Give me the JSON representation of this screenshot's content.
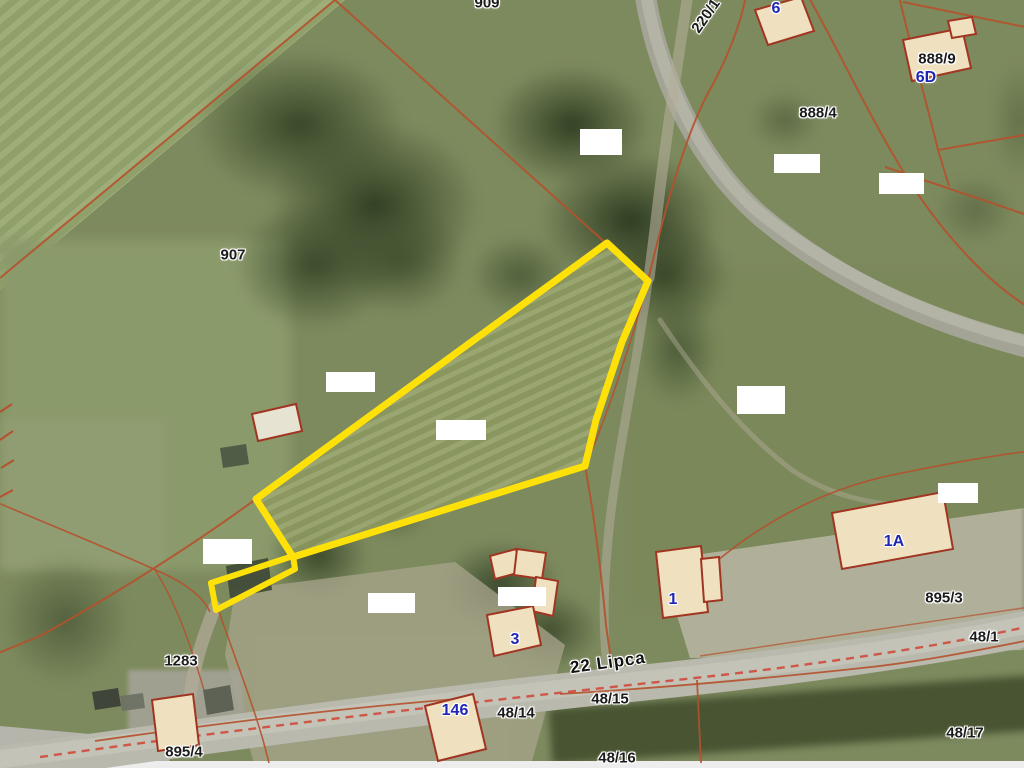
{
  "map": {
    "type": "cadastral-aerial-map",
    "street_label": {
      "text": "22 Lipca",
      "x": 608,
      "y": 663,
      "rotate": -8
    },
    "parcel_labels": [
      {
        "text": "909",
        "x": 487,
        "y": 3
      },
      {
        "text": "220/1",
        "x": 706,
        "y": 16,
        "rotate": -55
      },
      {
        "text": "907",
        "x": 233,
        "y": 255
      },
      {
        "text": "888/4",
        "x": 818,
        "y": 113
      },
      {
        "text": "888/9",
        "x": 937,
        "y": 59
      },
      {
        "text": "895/3",
        "x": 944,
        "y": 598
      },
      {
        "text": "48/1",
        "x": 984,
        "y": 637
      },
      {
        "text": "48/15",
        "x": 610,
        "y": 699
      },
      {
        "text": "48/14",
        "x": 516,
        "y": 713
      },
      {
        "text": "48/16",
        "x": 617,
        "y": 758
      },
      {
        "text": "48/17",
        "x": 965,
        "y": 733
      },
      {
        "text": "895/4",
        "x": 184,
        "y": 752
      },
      {
        "text": "1283",
        "x": 181,
        "y": 661
      }
    ],
    "address_labels": [
      {
        "text": "6",
        "x": 776,
        "y": 9
      },
      {
        "text": "6D",
        "x": 926,
        "y": 78
      },
      {
        "text": "1A",
        "x": 894,
        "y": 542
      },
      {
        "text": "1",
        "x": 673,
        "y": 600
      },
      {
        "text": "3",
        "x": 515,
        "y": 640
      },
      {
        "text": "146",
        "x": 455,
        "y": 711
      }
    ],
    "redactions": [
      {
        "x": 580,
        "y": 129,
        "w": 42,
        "h": 26
      },
      {
        "x": 774,
        "y": 154,
        "w": 46,
        "h": 19
      },
      {
        "x": 879,
        "y": 173,
        "w": 45,
        "h": 21
      },
      {
        "x": 326,
        "y": 372,
        "w": 49,
        "h": 20
      },
      {
        "x": 737,
        "y": 386,
        "w": 48,
        "h": 28
      },
      {
        "x": 436,
        "y": 420,
        "w": 50,
        "h": 20
      },
      {
        "x": 203,
        "y": 539,
        "w": 49,
        "h": 25
      },
      {
        "x": 368,
        "y": 593,
        "w": 47,
        "h": 20
      },
      {
        "x": 498,
        "y": 587,
        "w": 48,
        "h": 19
      },
      {
        "x": 938,
        "y": 483,
        "w": 40,
        "h": 20
      }
    ],
    "yellow_parcel": {
      "main_points": "607,243 648,281 622,342 596,420 585,466 293,557 256,499",
      "tail_points": "293,556 211,583 216,610 295,569",
      "stroke_width": 7
    },
    "road_surfaces": [
      {
        "path": "M645,-6 C658,75 696,158 758,214 C838,282 928,322 1030,348",
        "width": 21,
        "color": "#a5a599",
        "opacity": 0.95
      },
      {
        "path": "M646,-6 C659,70 694,152 754,208 C834,274 926,316 1030,342",
        "width": 12,
        "color": "#b6b6aa",
        "opacity": 0.8
      },
      {
        "path": "M-6,765 C180,740 400,708 620,685 C800,667 940,646 1030,628",
        "width": 36,
        "color": "#b9b9ae",
        "opacity": 1
      },
      {
        "path": "M-6,760 C180,736 410,704 625,682 C800,664 945,642 1030,624",
        "width": 18,
        "color": "#c7c7bb",
        "opacity": 0.75
      }
    ],
    "tracks": [
      {
        "path": "M688,-6 C678,60 664,150 655,230 L649,278",
        "width": 11,
        "opacity": 0.6
      },
      {
        "path": "M648,282 C636,370 618,450 610,520 C604,575 602,620 607,666",
        "width": 9,
        "opacity": 0.55
      },
      {
        "path": "M215,607 C202,640 194,665 190,696",
        "width": 13,
        "opacity": 0.7
      },
      {
        "path": "M660,320 C700,380 742,432 792,470 C830,496 872,505 918,506",
        "width": 5,
        "opacity": 0.45
      }
    ],
    "boundary_lines": [
      {
        "path": "M335,0 L0,278"
      },
      {
        "path": "M335,0 L648,281"
      },
      {
        "path": "M648,281 C664,212 686,130 712,86 C728,56 740,26 746,-4"
      },
      {
        "path": "M808,-4 C836,45 872,122 906,176 C940,230 986,282 1030,308"
      },
      {
        "path": "M899,-4 C910,45 926,100 938,150 L949,186"
      },
      {
        "path": "M903,2 L1030,28"
      },
      {
        "path": "M885,167 L1030,216"
      },
      {
        "path": "M938,150 L1030,134"
      },
      {
        "path": "M648,281 C632,340 606,420 585,466",
        "width": 1.6
      },
      {
        "path": "M585,466 C595,520 601,570 606,625 L611,660"
      },
      {
        "path": "M607,243 L256,499",
        "width": 1.4,
        "opacity": 0.6
      },
      {
        "path": "M256,499 C200,540 120,592 40,636 L-4,654"
      },
      {
        "path": "M-4,502 C55,527 112,550 158,571 C190,585 205,600 210,612",
        "width": 1.6
      },
      {
        "path": "M155,570 C178,606 192,650 204,690",
        "width": 1.4
      },
      {
        "path": "M219,612 C236,660 252,702 263,740 L269,763",
        "width": 1.6
      },
      {
        "path": "M95,741 C220,723 350,707 470,698",
        "width": 1.8
      },
      {
        "path": "M560,694 C660,688 760,679 862,668 C920,662 980,650 1030,640",
        "width": 1.8
      },
      {
        "path": "M697,680 L701,763",
        "width": 1.8
      },
      {
        "path": "M690,585 C760,518 832,486 902,473 C946,464 990,456 1030,451",
        "width": 1.6
      },
      {
        "path": "M700,656 C800,641 920,623 1030,607",
        "width": 1.5,
        "opacity": 0.7
      },
      {
        "path": "M40,757 C280,723 520,697 722,675 C842,661 952,644 1030,626",
        "dashed": true,
        "width": 2.4
      }
    ],
    "hatch_marks": [
      {
        "path": "M0,412 L12,404"
      },
      {
        "path": "M0,440 L13,431"
      },
      {
        "path": "M1,468 L14,460"
      },
      {
        "path": "M0,497 L13,490"
      }
    ],
    "sheds": [
      {
        "points": "220,448 246,444 249,464 223,468",
        "fill": "#4e5844"
      },
      {
        "points": "226,566 268,558 272,590 230,598",
        "fill": "#414c39"
      },
      {
        "points": "203,690 230,685 234,710 207,715",
        "fill": "#5a5f52"
      },
      {
        "points": "92,692 118,688 121,706 95,710",
        "fill": "#3c4136"
      },
      {
        "points": "120,696 143,693 145,708 122,711",
        "fill": "#6e7264"
      }
    ],
    "buildings": [
      {
        "points": "755,10 801,-3 814,31 768,45"
      },
      {
        "points": "903,40 962,28 971,68 912,81"
      },
      {
        "points": "948,21 972,17 976,34 952,38"
      },
      {
        "points": "252,414 296,404 302,431 258,441",
        "fill": "#e7e3d3"
      },
      {
        "points": "490,556 516,549 521,572 495,579"
      },
      {
        "points": "517,549 546,553 542,579 514,575"
      },
      {
        "points": "536,577 558,581 553,616 532,611"
      },
      {
        "points": "487,615 533,606 541,645 494,656"
      },
      {
        "points": "656,552 701,546 708,612 663,618"
      },
      {
        "points": "701,559 719,557 722,600 704,602"
      },
      {
        "points": "832,513 943,492 953,549 842,569"
      },
      {
        "points": "152,700 193,694 199,745 158,751"
      },
      {
        "points": "425,706 473,694 486,749 438,761"
      }
    ]
  },
  "colors": {
    "boundary": "#b5512c",
    "dashed": "#cf4b3c",
    "building_fill": "#efe0bf",
    "building_stroke": "#a03522",
    "yellow": "#ffe10a",
    "label_black": "#1b1b1b",
    "label_blue": "#2026b4",
    "track": "#b3ad9a"
  }
}
